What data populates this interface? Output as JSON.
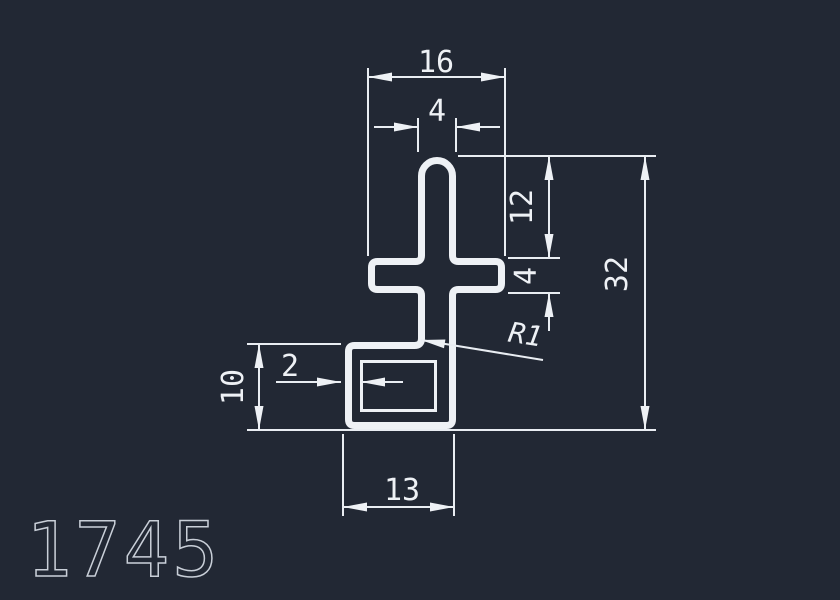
{
  "canvas": {
    "background": "#222834",
    "line_color": "#eef1f5",
    "part_label_color": "#c9cfd8"
  },
  "drawing": {
    "part_number": "1745",
    "dimensions": {
      "crossbar_width": "16",
      "stem_width": "4",
      "upper_stem_height": "12",
      "crossbar_thickness": "4",
      "overall_height": "32",
      "base_height": "10",
      "wall_thickness": "2",
      "base_width": "13",
      "fillet_radius": "R1"
    }
  }
}
